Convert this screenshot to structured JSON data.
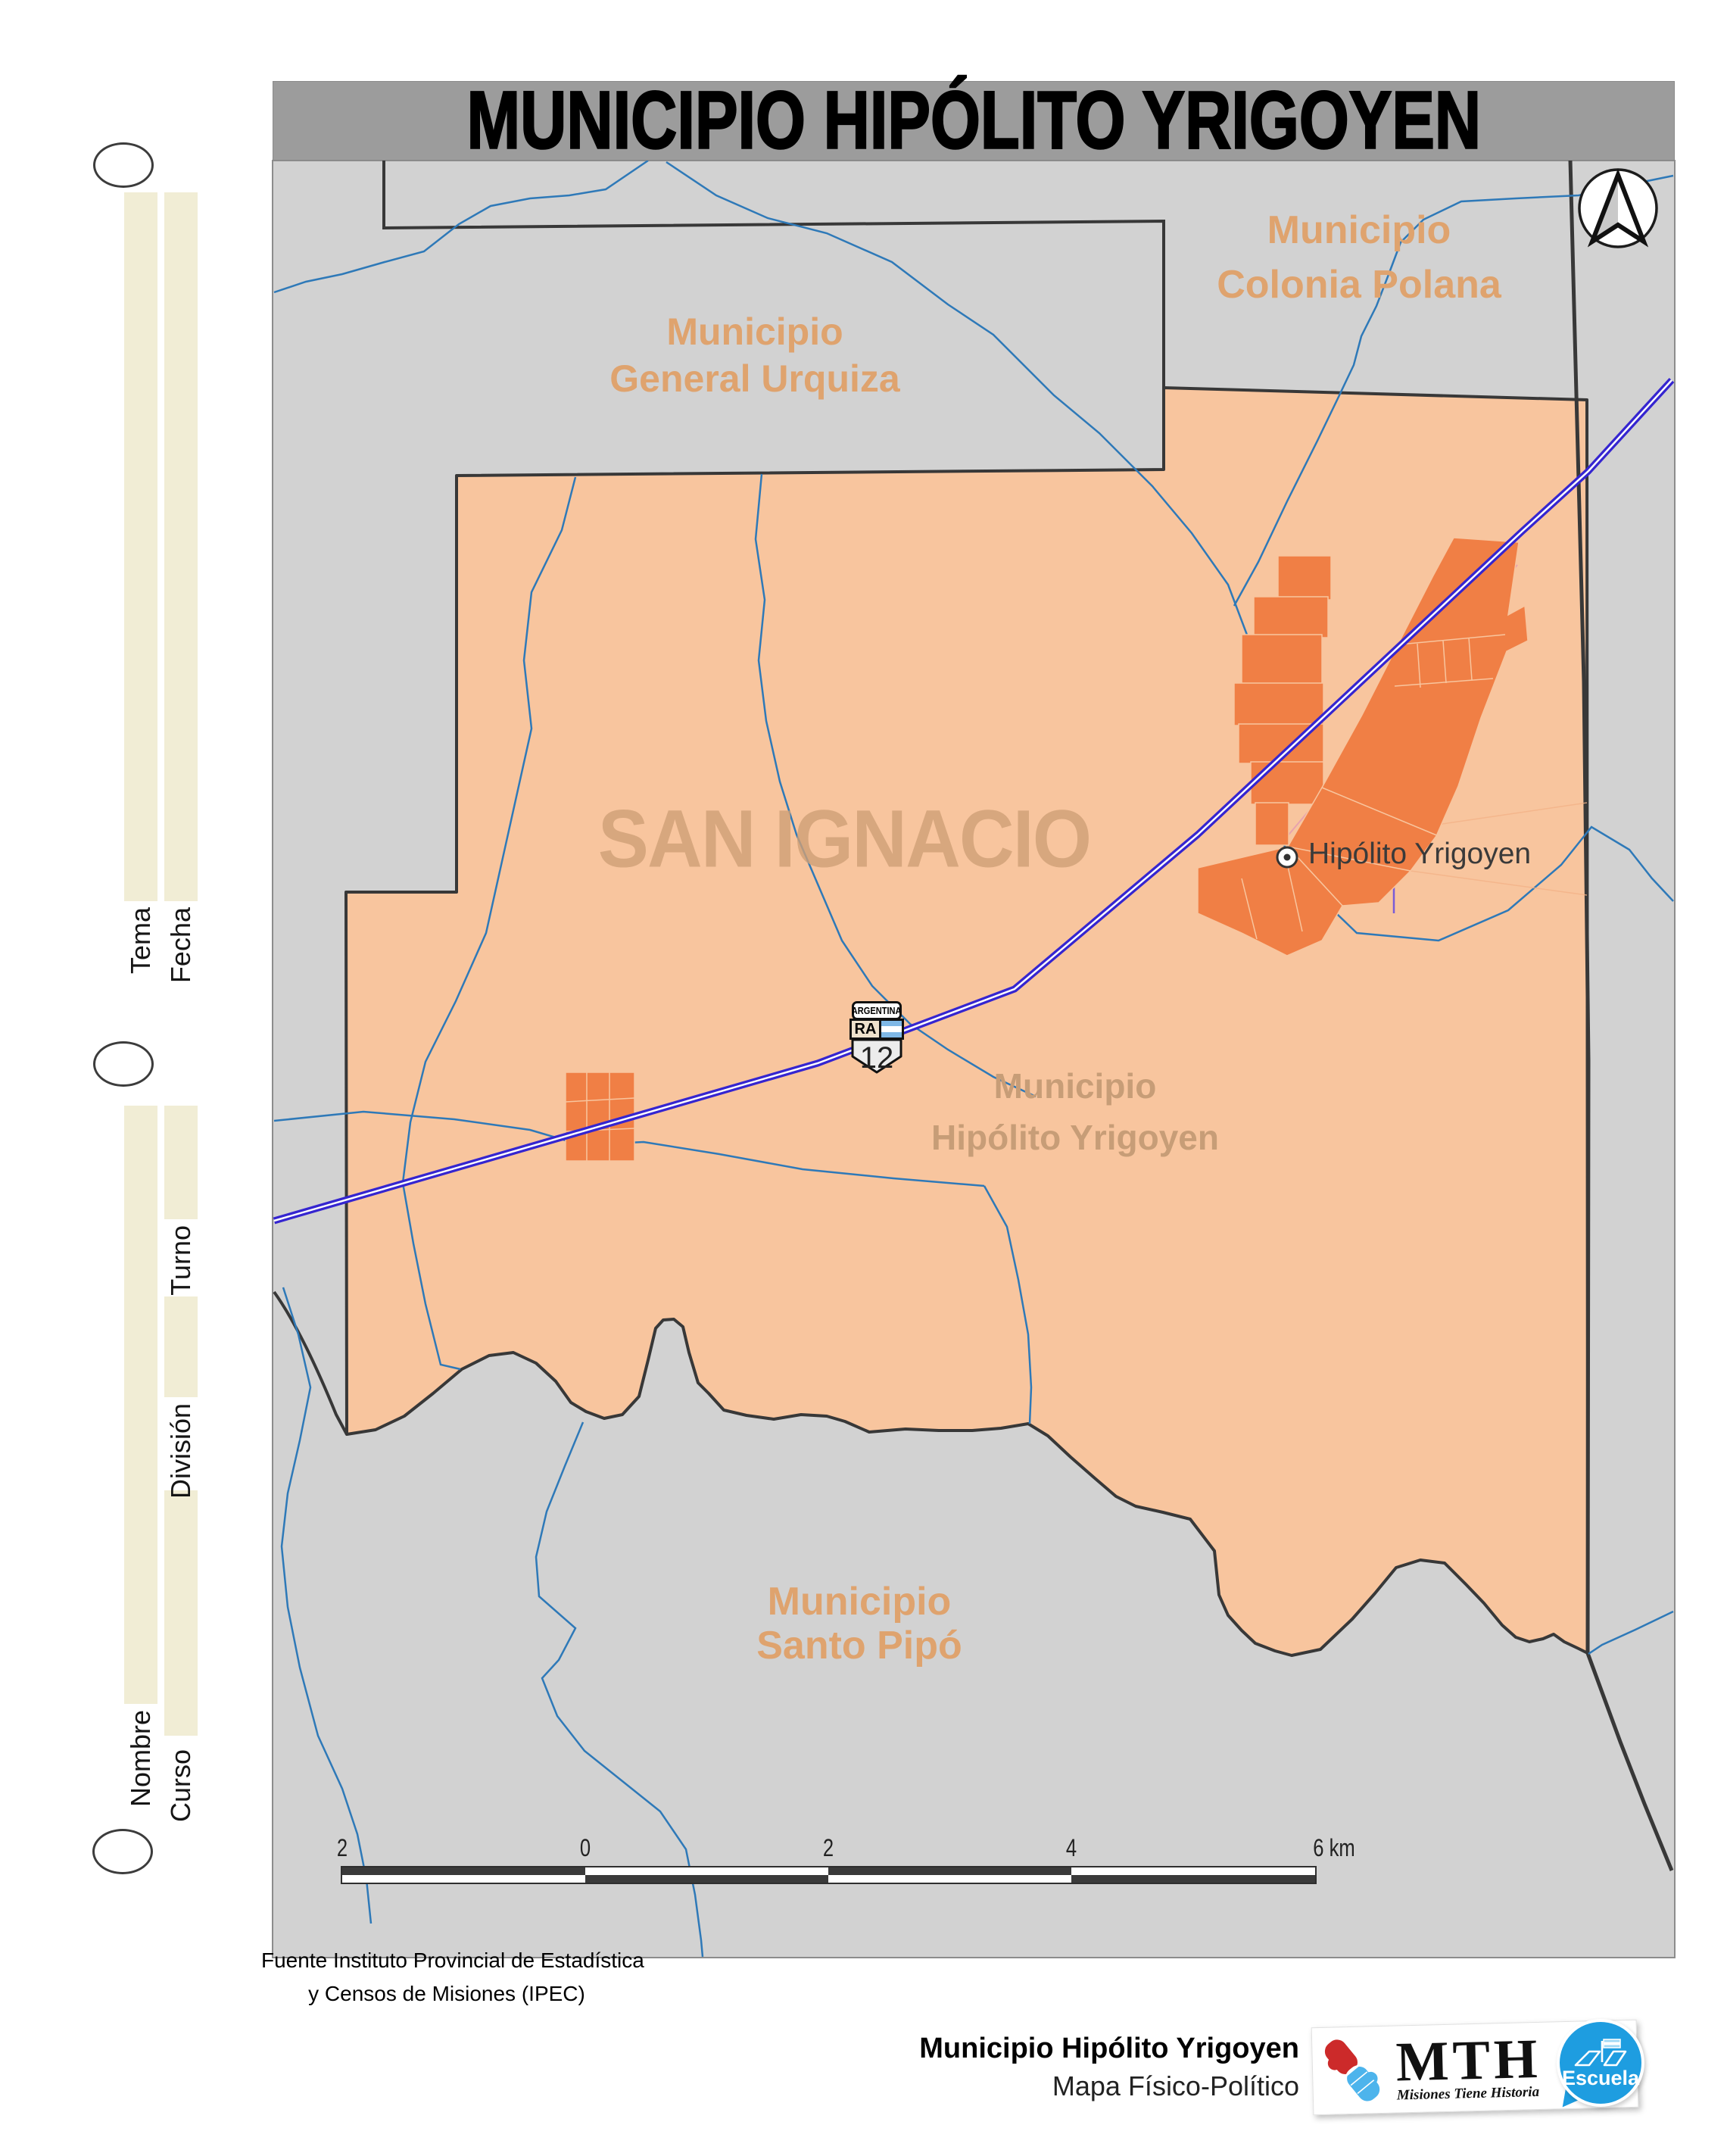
{
  "title": "MUNICIPIO HIPÓLITO YRIGOYEN",
  "margin_fields": {
    "tema": "Tema",
    "fecha": "Fecha",
    "turno": "Turno",
    "division": "División",
    "nombre": "Nombre",
    "curso": "Curso"
  },
  "map": {
    "regions": {
      "general_urquiza": {
        "line1": "Municipio",
        "line2": "General Urquiza"
      },
      "colonia_polana": {
        "line1": "Municipio",
        "line2": "Colonia Polana"
      },
      "santo_pipo": {
        "line1": "Municipio",
        "line2": "Santo Pipó"
      },
      "hipolito_yrigoyen": {
        "line1": "Municipio",
        "line2": "Hipólito Yrigoyen"
      },
      "department_watermark": "SAN IGNACIO"
    },
    "town": {
      "label": "Hipólito Yrigoyen"
    },
    "route_shield": {
      "country": "ARGENTINA",
      "code": "RA",
      "number": "12"
    },
    "scale_bar": {
      "labels": [
        "2",
        "0",
        "2",
        "4",
        "6 km"
      ]
    }
  },
  "source": {
    "line1": "Fuente Instituto Provincial de Estadística",
    "line2": "y Censos de Misiones (IPEC)"
  },
  "footer": {
    "map_name": "Municipio Hipólito Yrigoyen",
    "map_type": "Mapa Físico-Político",
    "mth_abbr": "MTH",
    "mth_tagline": "Misiones Tiene Historia",
    "escuela": "Escuela"
  },
  "colors": {
    "municipality_fill": "#f8c59e",
    "urban_fill": "#f07f45",
    "neighbor_gray": "#d2d2d2",
    "highway_blue": "#3525d0",
    "river_blue": "#2e79b8",
    "label_orange": "#dfa36e",
    "cream_strip": "#f1edd5",
    "escuela_blue": "#1e9de0",
    "title_bar_gray": "#9c9c9c"
  }
}
